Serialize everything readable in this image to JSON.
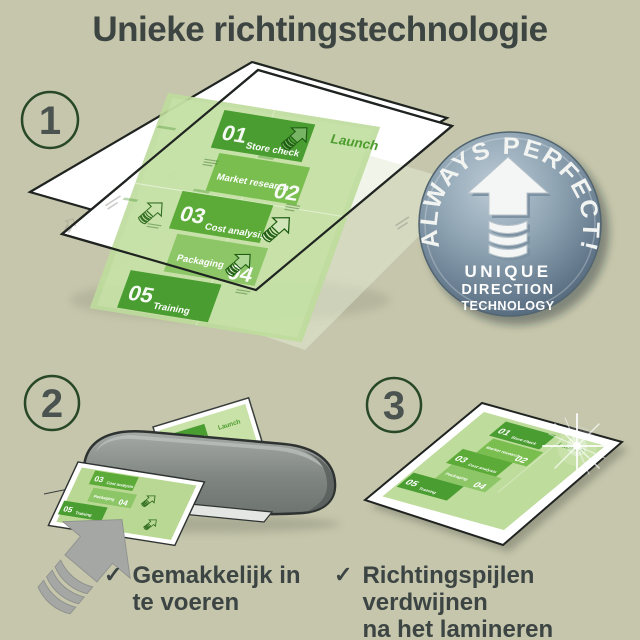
{
  "title": "Unieke richtingstechnologie",
  "steps": [
    "1",
    "2",
    "3"
  ],
  "badge": {
    "arc_text": "ALWAYS PERFECT!",
    "line1": "UNIQUE",
    "line2": "DIRECTION",
    "line3": "TECHNOLOGY"
  },
  "plan_document": {
    "launch": "Launch",
    "items": [
      {
        "num": "01",
        "label": "Store check"
      },
      {
        "num": "02",
        "label": "Market research"
      },
      {
        "num": "03",
        "label": "Cost analysis"
      },
      {
        "num": "04",
        "label": "Packaging"
      },
      {
        "num": "05",
        "label": "Training"
      }
    ]
  },
  "checklist": [
    {
      "line1": "Gemakkelijk in",
      "line2": "te voeren"
    },
    {
      "line1": "Richtingspijlen verdwijnen",
      "line2": "na het lamineren"
    }
  ],
  "colors": {
    "background": "#c5c6ab",
    "text": "#3c4543",
    "green_dark": "#4a9d31",
    "green_mid": "#7abe50",
    "green_doc": "#bedc9b",
    "badge_steel": "#6e8495",
    "laminator_gray": "#8b908e"
  }
}
